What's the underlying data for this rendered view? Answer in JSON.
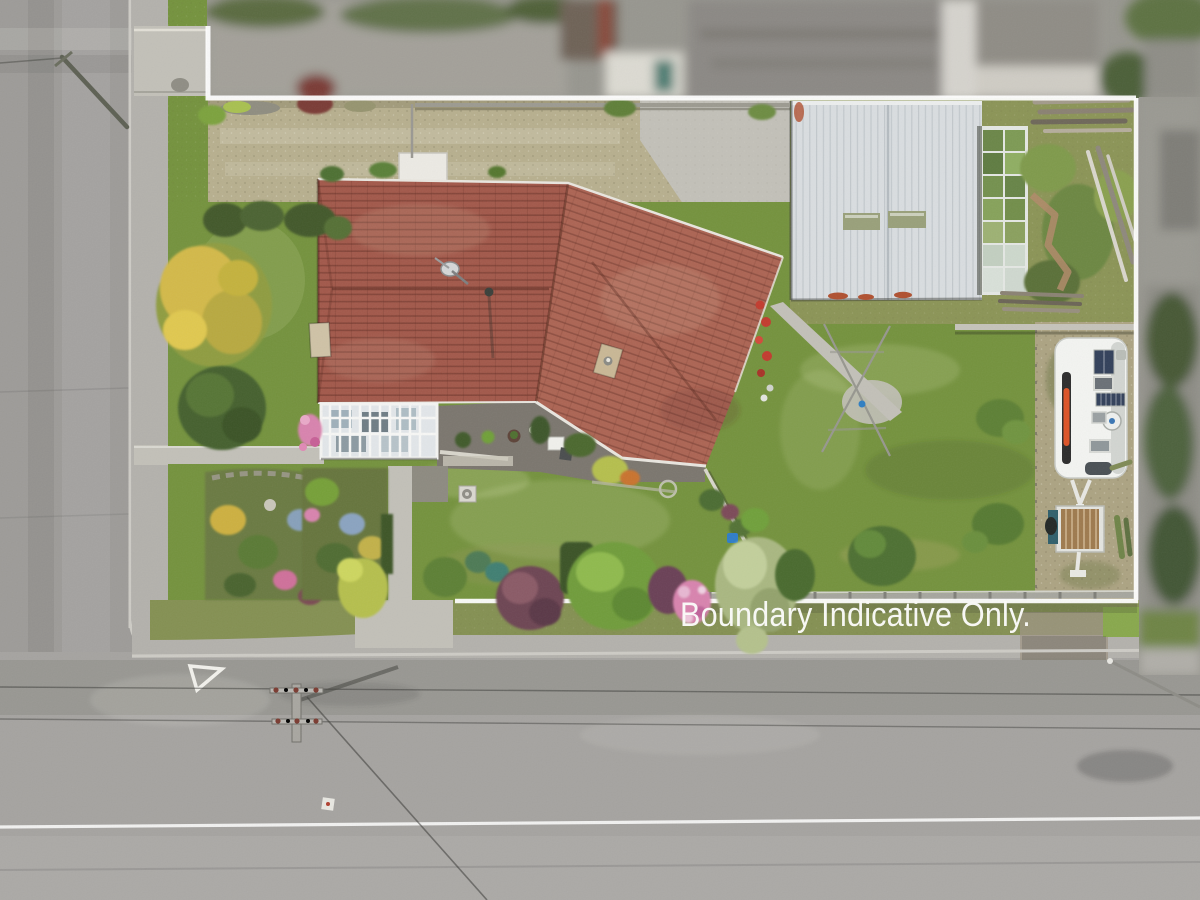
{
  "overlay": {
    "boundary_text": "Boundary Indicative Only."
  },
  "scene_type": "aerial drone photograph of residential property with boundary overlay",
  "colors": {
    "text": "#fbfbf9",
    "boundary": "#ffffff",
    "road": "#a5a3a0",
    "road_left": "#9d9b98",
    "footpath": "#b3b1ac",
    "curb": "#cdcbc5",
    "grass": "#74923d",
    "grass_light": "#88a84c",
    "grass_dark": "#5c7a30",
    "grass_olive": "#849052",
    "gravel": "#b7af8e",
    "gravel_right": "#aca382",
    "roof": "#a2584a",
    "roof_light": "#ac6453",
    "roof_line": "#7e4336",
    "gutter": "#e9e6df",
    "shed": "#d9dde0",
    "shed_rib": "#c2c8cc",
    "skylight": "#99a07a",
    "rust": "#b0502f",
    "greenhouse_frame": "#e4e7e3",
    "conservatory": "#e2e6e9",
    "patio": "#7b766e",
    "path": "#c2c0b8",
    "hedge_dark": "#42582b",
    "tree_gold": "#d3b948",
    "tree_sage": "#a9b781",
    "shrub_maroon": "#6d4452",
    "flower_pink": "#d883ae",
    "flower_red": "#c23b2e",
    "caravan": "#f3f4f1",
    "solar_panel": "#32405a",
    "caravan_stripe": "#dd5327",
    "trailer_deck": "#9e7a4e",
    "trailer_teal": "#2f5f6b",
    "blur_grey": "#97968f"
  }
}
